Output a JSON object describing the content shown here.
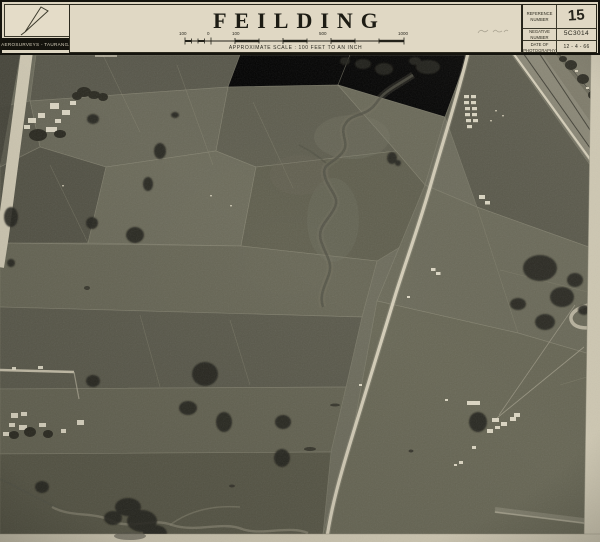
{
  "header": {
    "logo": {
      "label": "AEROSURVEYS - TAURANGA",
      "icon": "pen-nib-triangle-logo"
    },
    "title": "FEILDING",
    "scale": {
      "ticks": [
        "100",
        "0",
        "100",
        "500",
        "1000"
      ],
      "caption": "APPROXIMATE SCALE  :  100 FEET TO AN INCH"
    },
    "reference": {
      "rows": [
        {
          "label": "REFERENCE NUMBER",
          "value": "15"
        },
        {
          "label": "NEGATIVE NUMBER",
          "value": "5C3014"
        },
        {
          "label": "DATE OF PHOTOGRAPHY",
          "value": "12 - 4 - 66"
        }
      ]
    }
  },
  "photo": {
    "type": "black-and-white vertical aerial photograph",
    "subject": "patchwork farmland and paddocks on the edge of Feilding, New Zealand",
    "features": [
      "paddock field boundaries",
      "main road running from top centre to bottom centre",
      "railway corridor in top right corner",
      "meandering stream through upper middle paddocks",
      "dark shelterbelt and hedgerow trees",
      "farm building clusters with white roofs",
      "glasshouse rows beside main road",
      "pale photo margins on right and bottom edges",
      "faint illegible pencil annotation beside reference box"
    ]
  },
  "colors": {
    "paper": "#ddd5c1",
    "ink": "#15140e",
    "photo_base": "#6f6e5e",
    "photo_margin": "#d6cfb9",
    "road": "#d8d1bb",
    "tree": "#21201a"
  }
}
